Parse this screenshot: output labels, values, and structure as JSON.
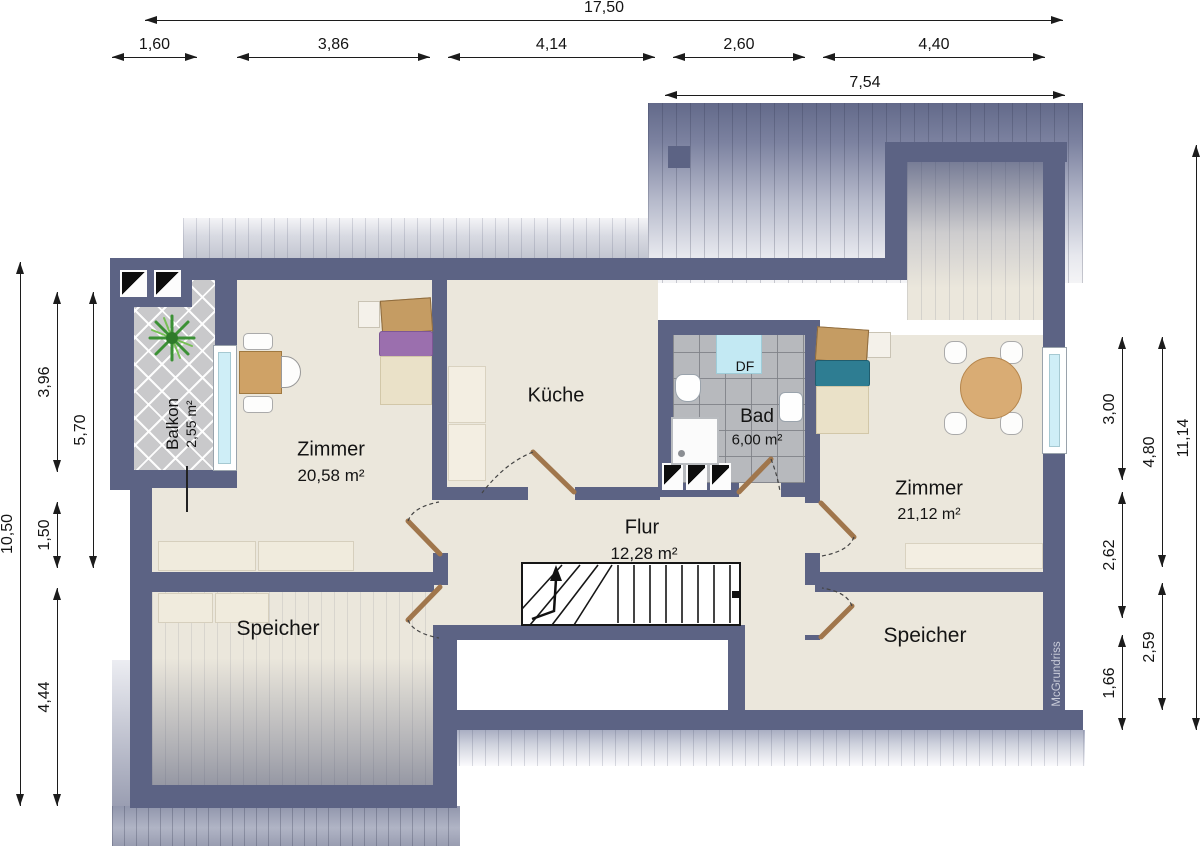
{
  "rooms": {
    "zimmer_left": {
      "name": "Zimmer",
      "area": "20,58 m²"
    },
    "kueche": {
      "name": "Küche"
    },
    "bad": {
      "name": "Bad",
      "area": "6,00 m²"
    },
    "flur": {
      "name": "Flur",
      "area": "12,28 m²"
    },
    "zimmer_right": {
      "name": "Zimmer",
      "area": "21,12 m²"
    },
    "speicher_left": {
      "name": "Speicher"
    },
    "speicher_right": {
      "name": "Speicher"
    },
    "balkon": {
      "name": "Balkon",
      "area": "2,55 m²"
    }
  },
  "annotations": {
    "roof_window_label": "DF",
    "watermark": "McGrundriss"
  },
  "dimensions": {
    "top_total": "17,50",
    "top_segments": [
      "1,60",
      "3,86",
      "4,14",
      "2,60",
      "4,40"
    ],
    "top_right_width": "7,54",
    "left_outer": "10,50",
    "left_mid": "5,70",
    "left_segments": [
      "3,96",
      "1,50",
      "4,44"
    ],
    "right_inner": [
      "3,00",
      "2,62",
      "1,66"
    ],
    "right_middle": [
      "4,80",
      "2,59"
    ],
    "right_outer": "11,14"
  },
  "colors": {
    "wall": "#5c6384",
    "floor": "#ebe7dc",
    "balcony_tile": "#c9c9cb",
    "bath_tile": "#b7b9bd",
    "window_glass": "#cfeef7",
    "door_leaf": "#a0764c",
    "roof_dark": "#636a8a",
    "bed_blanket_purple": "#9b6fae",
    "bed_blanket_teal": "#2e7d92"
  }
}
